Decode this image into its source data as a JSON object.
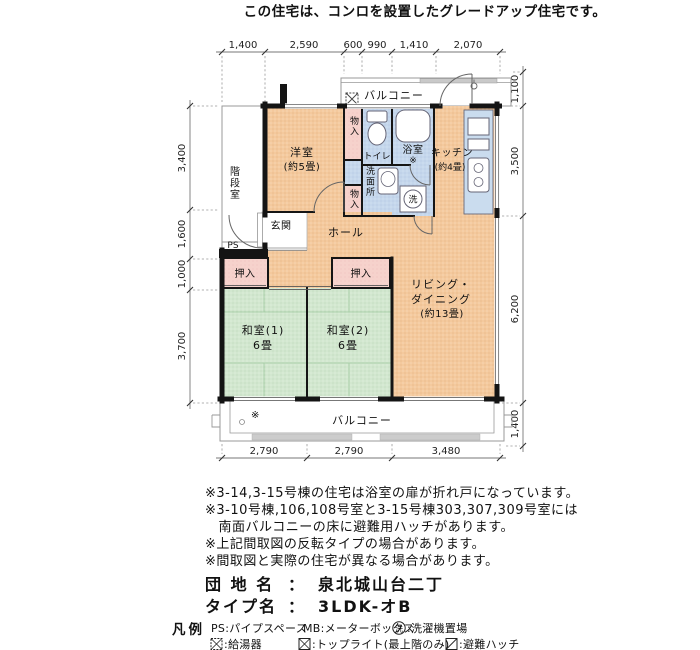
{
  "header": {
    "title": "この住宅は、コンロを設置したグレードアップ住宅です。"
  },
  "plan": {
    "dims": {
      "top": [
        "1,400",
        "2,590",
        "600",
        "990",
        "1,410",
        "2,070"
      ],
      "bottom": [
        "2,790",
        "2,790",
        "3,480"
      ],
      "left": [
        "3,400",
        "1,600",
        "1,000",
        "3,700"
      ],
      "right": [
        "1,100",
        "3,500",
        "6,200",
        "1,400"
      ]
    },
    "rooms": {
      "stairwell": "階段室",
      "balcony_top": "バルコニー",
      "balcony_bottom": "バルコニー",
      "balcony_mark": "※",
      "western": {
        "name": "洋室",
        "size": "(約5畳)"
      },
      "closet_top": "物入",
      "closet_mid": "物入",
      "toilet": "トイレ",
      "bath": {
        "name": "浴室",
        "mark": "※"
      },
      "washroom": "洗面所",
      "laundry": "洗",
      "kitchen": {
        "name": "キッチン",
        "size": "(約4畳)"
      },
      "entrance": "玄関",
      "hall": "ホール",
      "ps": "PS",
      "closet1": "押入",
      "closet2": "押入",
      "japanese1": {
        "name": "和室(1)",
        "size": "6畳"
      },
      "japanese2": {
        "name": "和室(2)",
        "size": "6畳"
      },
      "living": {
        "name1": "リビング・",
        "name2": "ダイニング",
        "size": "(約13畳)"
      }
    }
  },
  "notes": [
    "※3-14,3-15号棟の住宅は浴室の扉が折れ戸になっています。",
    "※3-10号棟,106,108号室と3-15号棟303,307,309号室には",
    "　南面バルコニーの床に避難用ハッチがあります。",
    "※上記間取図の反転タイプの場合があります。",
    "※間取図と実際の住宅が異なる場合があります。"
  ],
  "estate": {
    "label": "団 地 名",
    "sep": "：",
    "value": "泉北城山台二丁"
  },
  "unit_type": {
    "label": "タイプ名",
    "sep": "：",
    "value": "3LDK-オB"
  },
  "legend": {
    "title": "凡例",
    "ps": "PS:パイプスペース",
    "mb": "MB:メーターボックス",
    "laundry_sym": "洗",
    "laundry": ":洗濯機置場",
    "heater": ":給湯器",
    "toplight": ":トップライト(最上階のみ)",
    "hatch": ":避難ハッチ"
  },
  "colors": {
    "orange": "#f4c99d",
    "green": "#d2e7cf",
    "pink": "#f6d2cc",
    "blue": "#c5d7ec",
    "counter": "#cadcEE",
    "tatami": "#a9cfa9",
    "wall": "#141414"
  }
}
